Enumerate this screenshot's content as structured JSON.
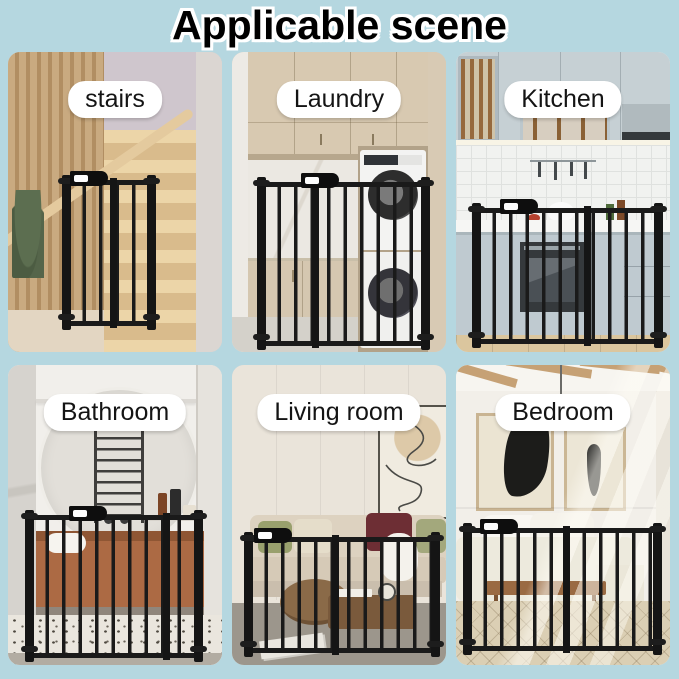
{
  "title": "Applicable scene",
  "colors": {
    "background": "#b5d7e0",
    "label_background": "#ffffff",
    "label_text": "#141414",
    "title_text": "#000000",
    "title_outline": "#ffffff",
    "gate": "#1a1a1a"
  },
  "panels": [
    {
      "id": "stairs",
      "label": "stairs"
    },
    {
      "id": "laundry",
      "label": "Laundry"
    },
    {
      "id": "kitchen",
      "label": "Kitchen"
    },
    {
      "id": "bathroom",
      "label": "Bathroom"
    },
    {
      "id": "living-room",
      "label": "Living room"
    },
    {
      "id": "bedroom",
      "label": "Bedroom"
    }
  ]
}
